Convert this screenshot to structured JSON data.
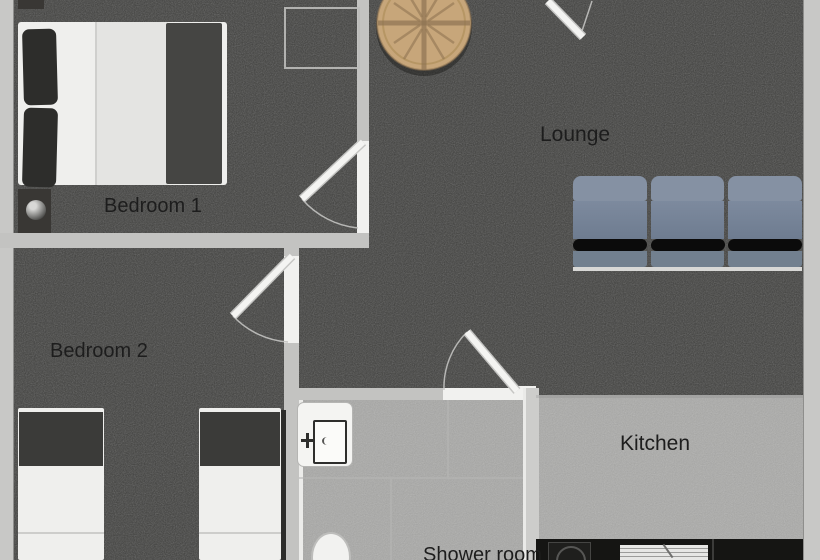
{
  "plan": {
    "type": "apartment-floor-plan",
    "rooms": {
      "bedroom1": {
        "label": "Bedroom 1"
      },
      "bedroom2": {
        "label": "Bedroom 2"
      },
      "lounge": {
        "label": "Lounge"
      },
      "kitchen": {
        "label": "Kitchen"
      },
      "shower_room": {
        "label": "Shower room"
      }
    },
    "furniture": [
      "double-bed",
      "nightstand",
      "bedside-lamp",
      "wardrobe-outline",
      "round-dining-table",
      "sofa",
      "single-bed-left",
      "single-bed-right",
      "washbasin",
      "toilet",
      "kitchen-counter",
      "cooktop",
      "oven",
      "door-leaf",
      "door-swing-arc"
    ],
    "colors": {
      "carpet": "#4d4d4b",
      "tile_floor": "#9e9e9c",
      "kitchen_floor": "#a3a3a1",
      "wall": "#c6c6c4",
      "door_white": "#f1f1ef",
      "sofa_blue": "#7b8a9e",
      "table_wood": "#c9a97b",
      "counter_dark": "#151513",
      "label_text": "#1d1d1d"
    }
  }
}
